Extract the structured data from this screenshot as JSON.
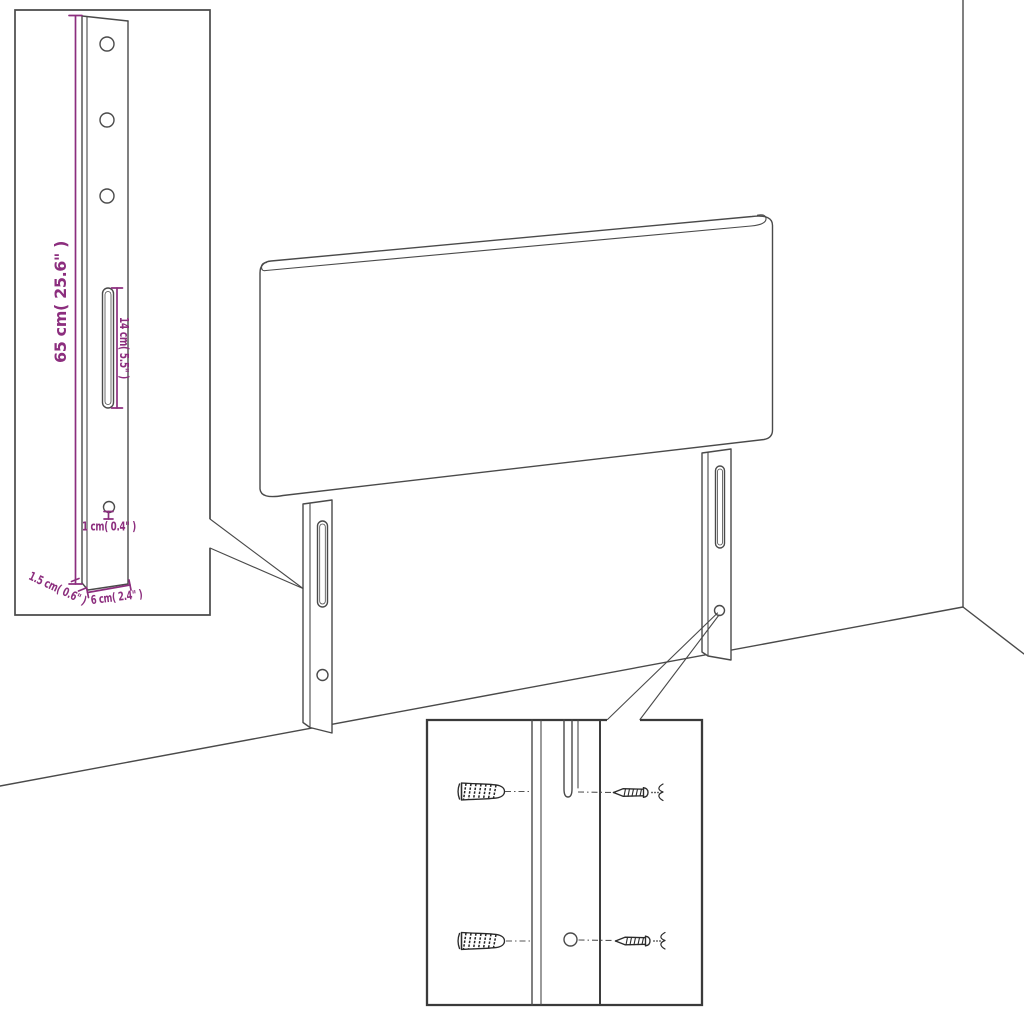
{
  "diagram": {
    "type": "product-dimension-diagram",
    "background": "#ffffff",
    "line_color": "#4a4a4a",
    "dimension_color": "#8C2E7E",
    "leg_detail": {
      "dim_height": "65 cm( 25.6\" )",
      "dim_slot_length": "14 cm( 5.5\" )",
      "dim_hole": "1 cm( 0.4\" )",
      "dim_thickness": "1.5 cm( 0.6\" )",
      "dim_width": "6 cm( 2.4\" )",
      "hole_count": 4,
      "slot_count": 1
    },
    "hardware_detail": {
      "rows": 2,
      "part_icons": [
        "wall-plug-icon",
        "screw-icon",
        "leg-slot-icon",
        "leg-hole-icon"
      ]
    },
    "scene": {
      "part_icons": [
        "headboard-icon",
        "left-leg-icon",
        "right-leg-icon",
        "wall-corner-icon"
      ]
    }
  }
}
